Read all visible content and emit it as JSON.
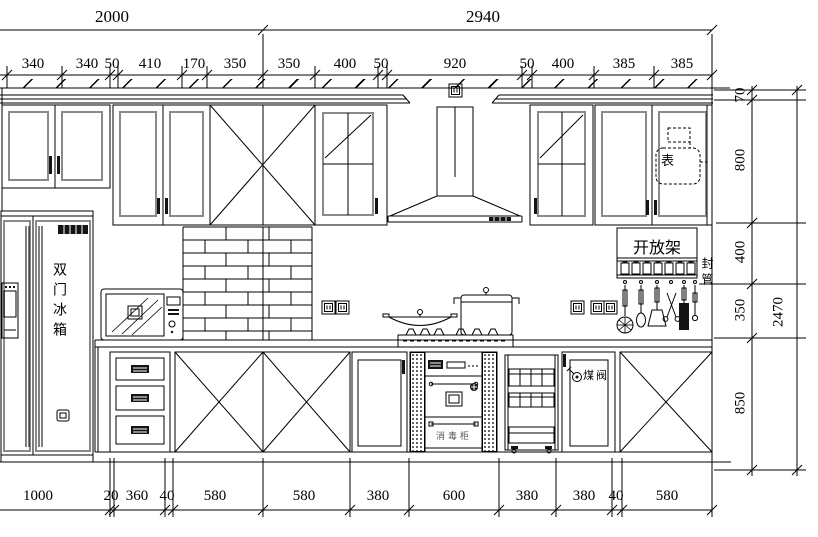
{
  "page": {
    "background": "#ffffff",
    "line_color": "#000000",
    "panel_line_color": "#8a8a8a"
  },
  "dimensions": {
    "top_overall": [
      "2000",
      "2940"
    ],
    "top_segments": [
      "340",
      "340",
      "50",
      "410",
      "170",
      "350",
      "350",
      "400",
      "50",
      "920",
      "50",
      "400",
      "385",
      "385"
    ],
    "right_segments": [
      "70",
      "800",
      "400",
      "350",
      "850"
    ],
    "right_overall": "2470",
    "bottom_segments": [
      "1000",
      "20",
      "360",
      "40",
      "580",
      "580",
      "380",
      "600",
      "380",
      "380",
      "40",
      "580"
    ]
  },
  "annotations": {
    "refrigerator": "双门冰箱",
    "open_shelf": "开放架",
    "boxed_pipe": "封管",
    "gas_meter": "表",
    "sterilizer_cabinet": "消毒柜",
    "gas_valve": "煤阀"
  },
  "icons": {
    "socket_outlet": "double-square-socket",
    "hood_badge": "dark-brand-block",
    "fridge_badge": "dark-brand-block"
  }
}
